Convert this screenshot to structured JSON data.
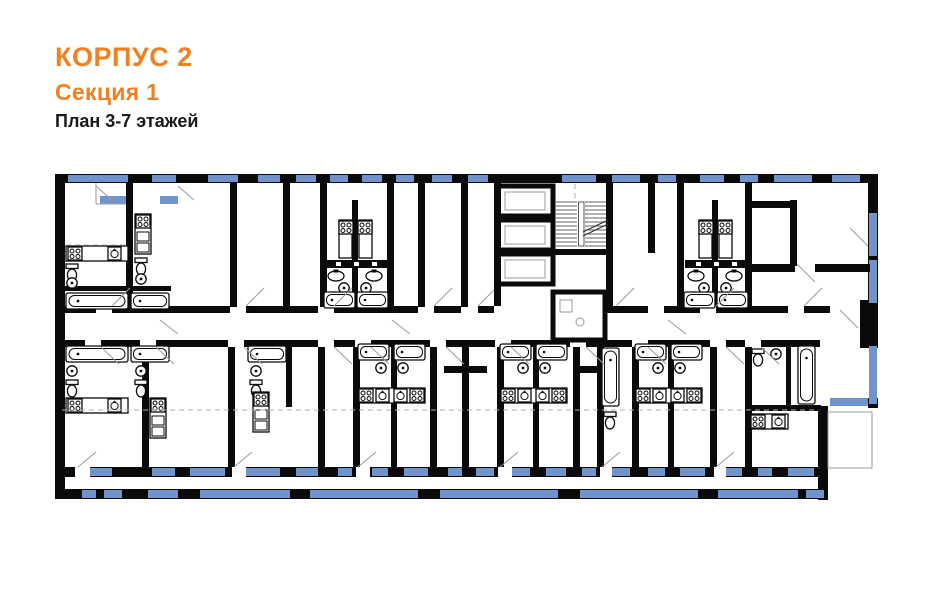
{
  "header": {
    "building": "КОРПУС 2",
    "section": "Секция 1",
    "floors_label": "План 3-7 этажей"
  },
  "colors": {
    "accent": "#EF8122",
    "wall": "#0a0a0a",
    "window": "#7093CB",
    "line": "#9b9b9b",
    "dashcol": "#b0b0b0",
    "text": "#1a1a1a"
  },
  "plan": {
    "kind": "residential-floor-plan",
    "depicted_elements": [
      "exterior-walls",
      "interior-walls",
      "windows",
      "balcony-glazing",
      "loggia",
      "staircase",
      "elevator-shafts",
      "corridor",
      "bathtub",
      "wash-sink",
      "toilet",
      "stove",
      "kitchen-counter",
      "door-swing"
    ]
  }
}
